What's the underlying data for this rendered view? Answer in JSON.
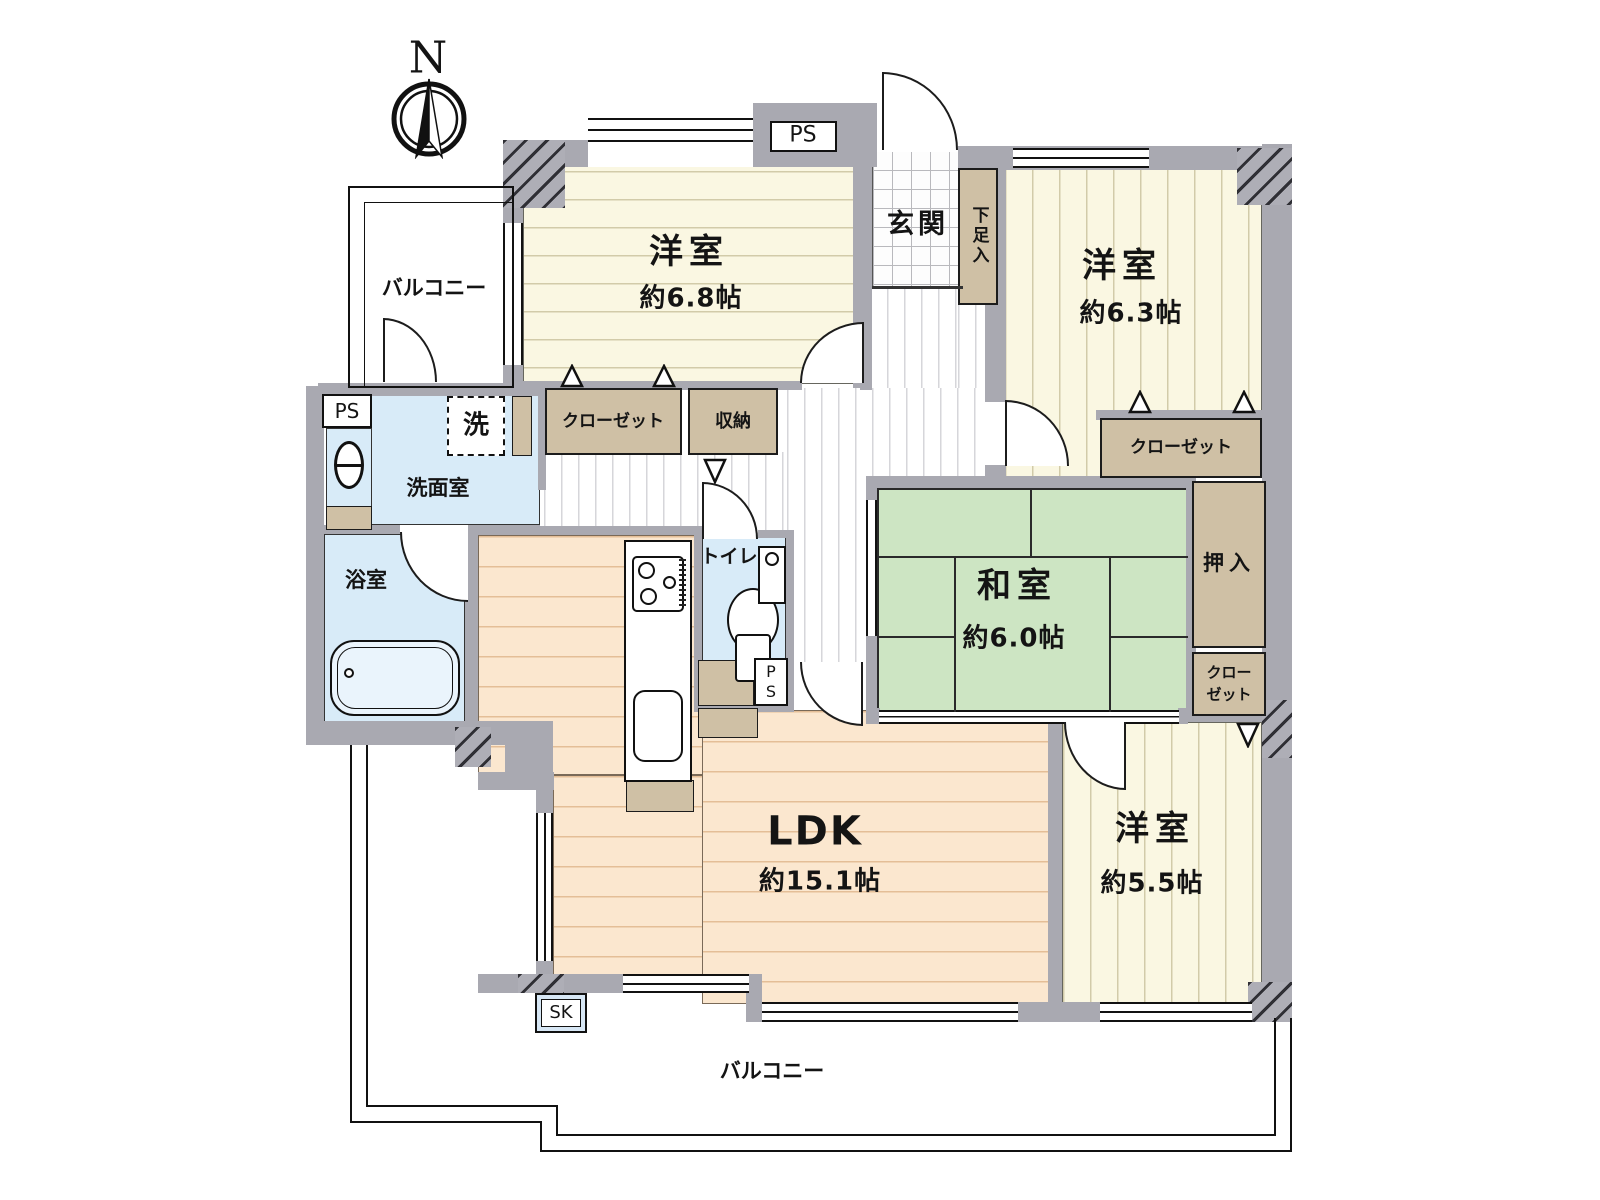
{
  "compass": {
    "north_label": "N"
  },
  "labels": {
    "balcony_left": "バルコニー",
    "balcony_bottom": "バルコニー",
    "entrance": "玄関",
    "shoe_box": "下足入",
    "pipe_space": "PS",
    "pipe_space_p": "P",
    "pipe_space_s": "S",
    "slop_sink": "SK",
    "closet": "クローゼット",
    "closet_line1": "クロー",
    "closet_line2": "ゼット",
    "storage": "収納",
    "oshiire": "押入",
    "washroom": "洗面室",
    "washing_machine": "洗",
    "bathroom": "浴室",
    "toilet": "トイレ"
  },
  "rooms": {
    "western_1": {
      "name": "洋室",
      "size": "約6.8帖"
    },
    "western_2": {
      "name": "洋室",
      "size": "約6.3帖"
    },
    "japanese": {
      "name": "和室",
      "size": "約6.0帖"
    },
    "ldk": {
      "name": "LDK",
      "size": "約15.1帖"
    },
    "western_3": {
      "name": "洋室",
      "size": "約5.5帖"
    }
  },
  "colors": {
    "wall": "#a9a9b1",
    "western_room_floor": "#faf7e2",
    "ldk_floor": "#fbe7cf",
    "tatami": "#cde5c3",
    "wet_area": "#d8ebf8",
    "closet_tan": "#cfc0a5"
  }
}
